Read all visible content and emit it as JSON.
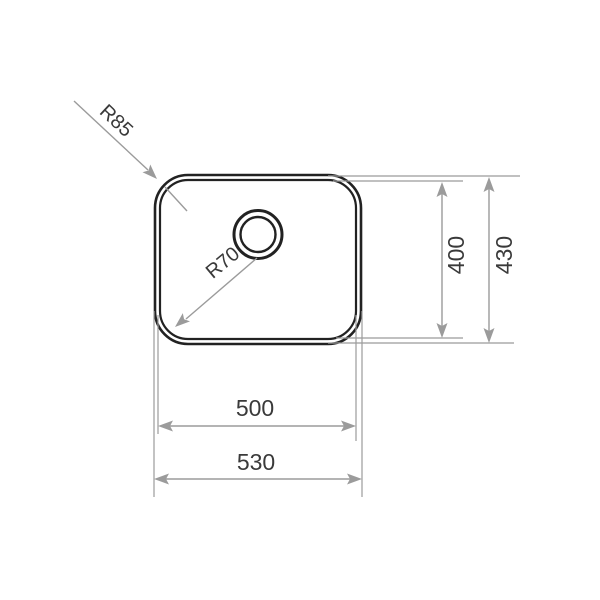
{
  "diagram": {
    "type": "technical-drawing",
    "subject": "undermount sink bowl - top view with dimensions",
    "radius_callouts": [
      {
        "id": "outer-corner-radius",
        "label": "R85"
      },
      {
        "id": "inner-corner-radius",
        "label": "R70"
      }
    ],
    "dimensions": [
      {
        "id": "inner-height",
        "label": "400",
        "orientation": "vertical"
      },
      {
        "id": "outer-height",
        "label": "430",
        "orientation": "vertical"
      },
      {
        "id": "inner-width",
        "label": "500",
        "orientation": "horizontal"
      },
      {
        "id": "outer-width",
        "label": "530",
        "orientation": "horizontal"
      }
    ],
    "colors": {
      "outline": "#222222",
      "dimension_lines": "#9b9b9b",
      "text": "#3a3a3a",
      "background": "#ffffff"
    }
  }
}
